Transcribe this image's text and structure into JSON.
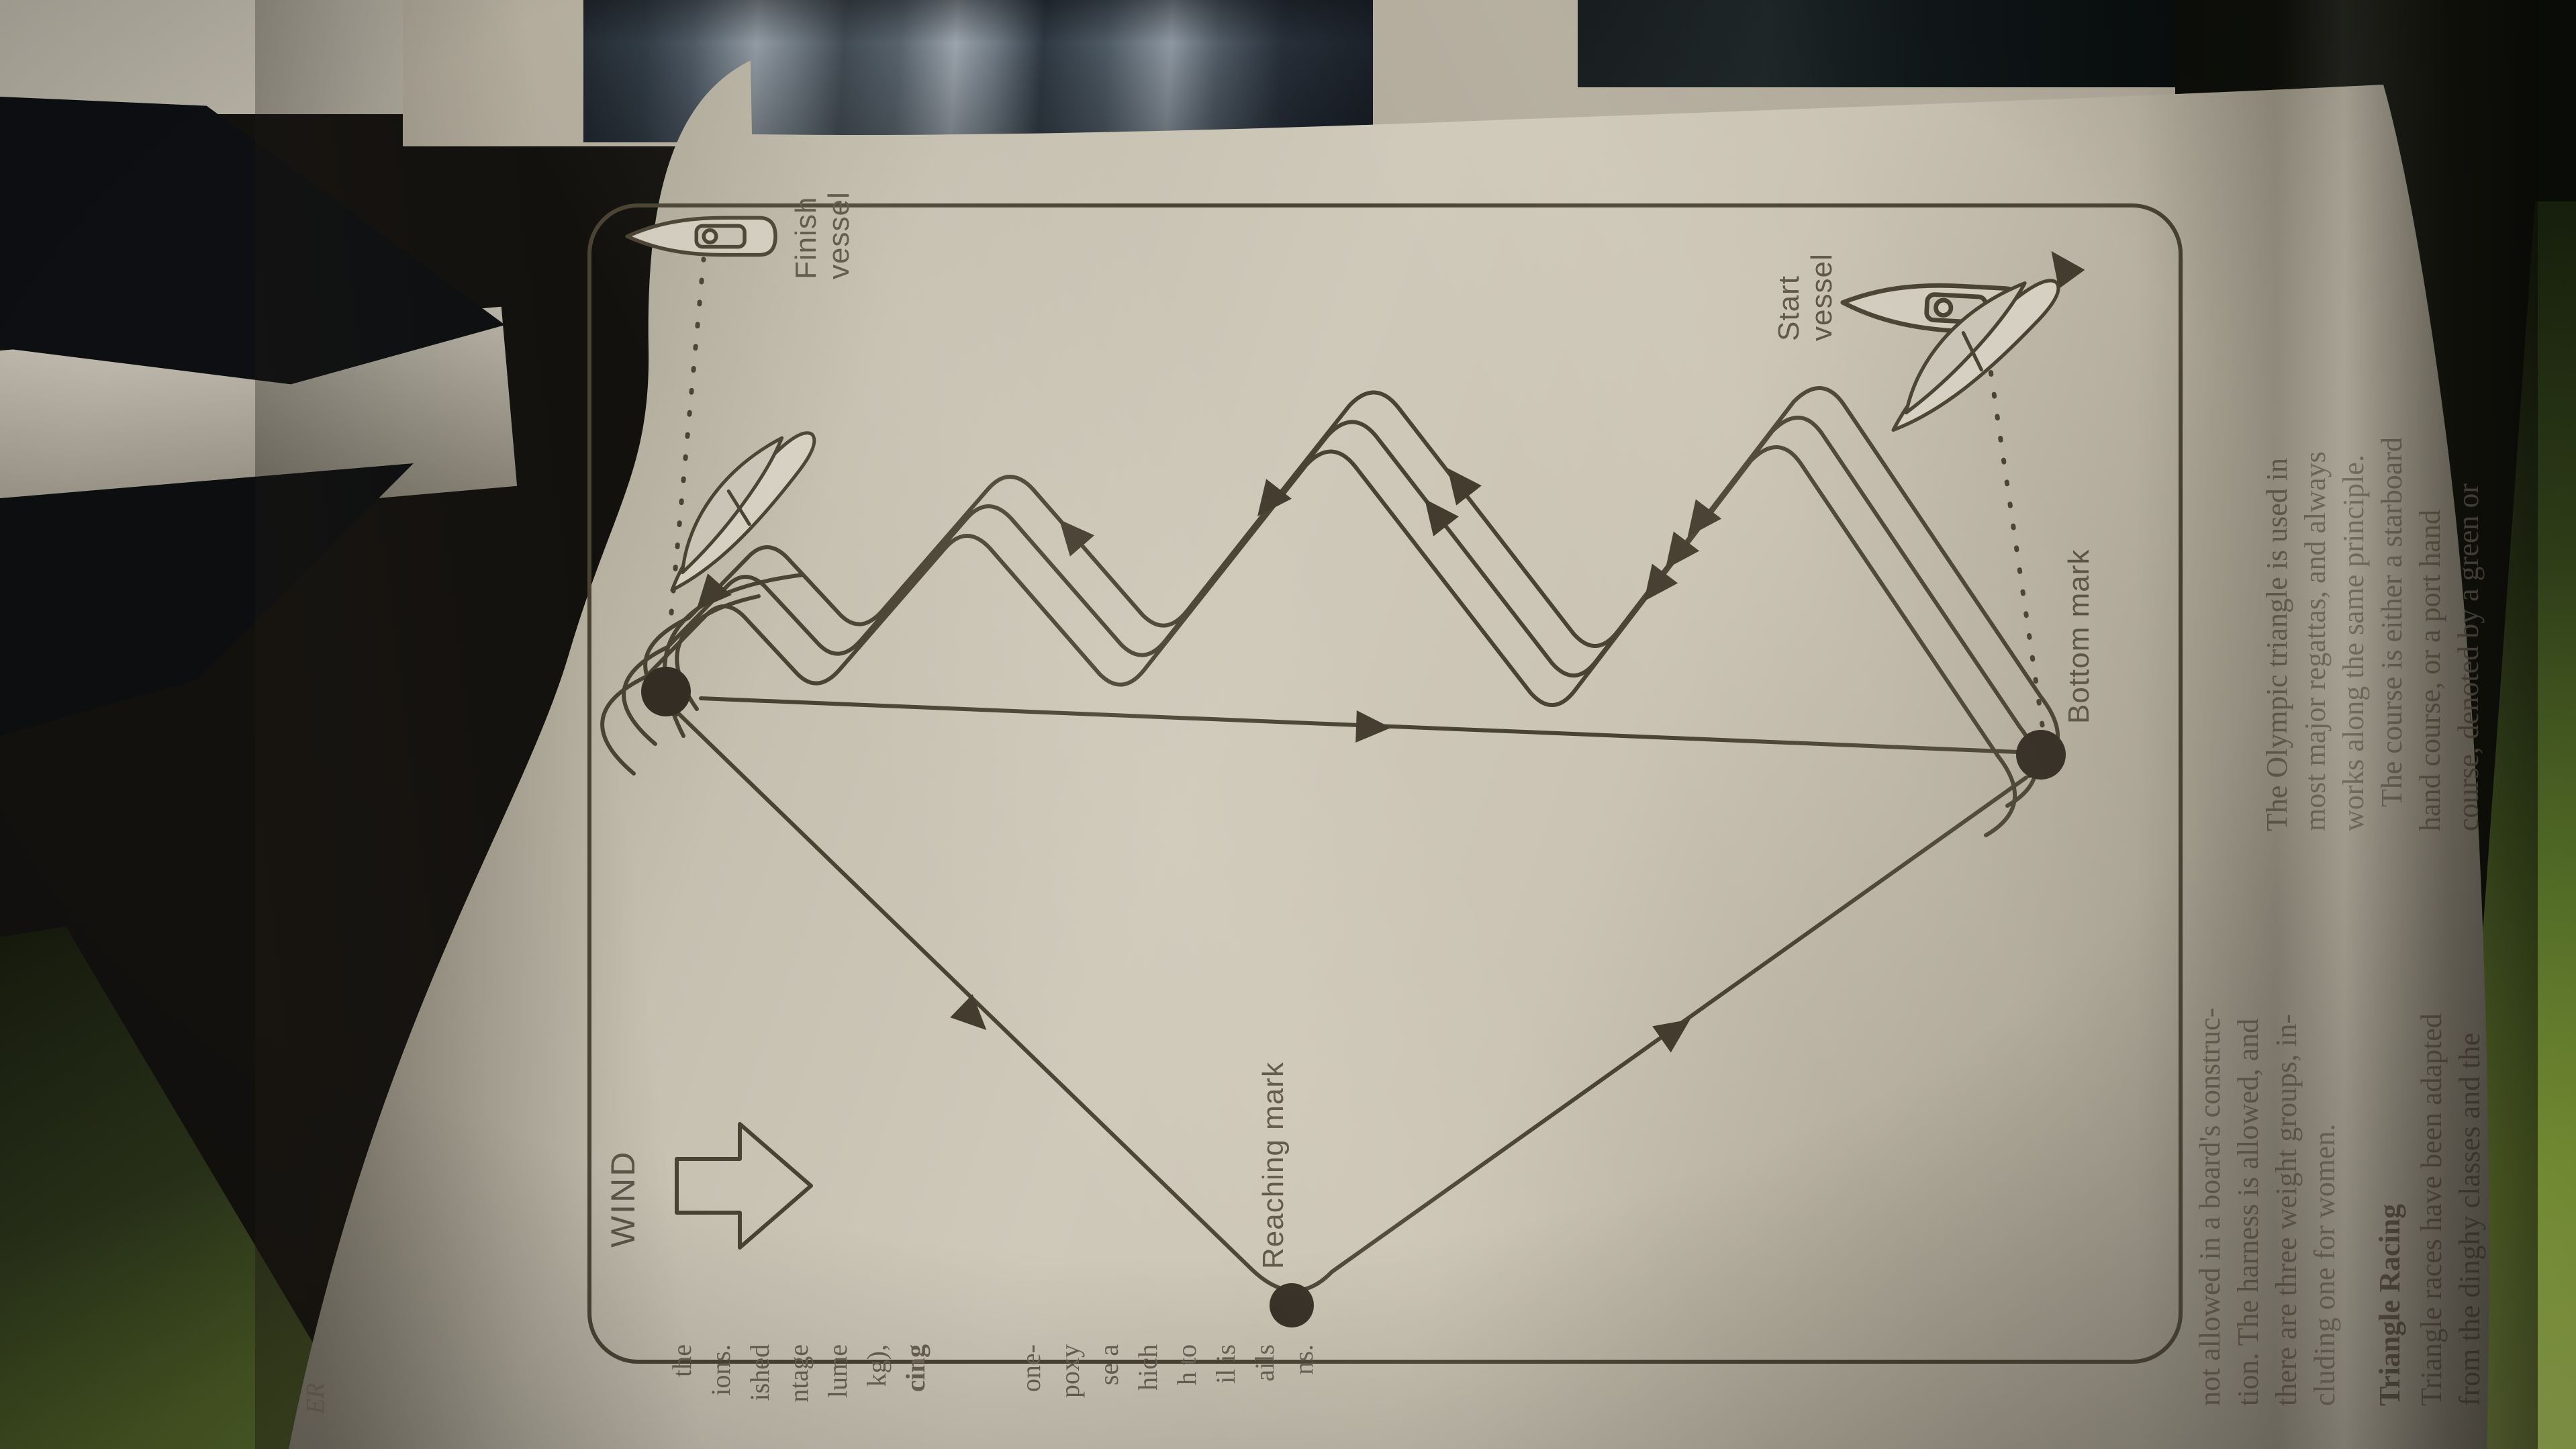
{
  "diagram": {
    "wind_label": "WIND",
    "reaching_mark_label": "Reaching mark",
    "bottom_mark_label": "Bottom mark",
    "finish_vessel_label": "Finish vessel",
    "start_vessel_label": "Start vessel"
  },
  "text_columns": {
    "left": {
      "lines": [
        "not allowed in a board's construc-",
        "tion. The harness is allowed, and",
        "there are three weight groups, in-",
        "cluding one for women."
      ],
      "heading": "Triangle Racing",
      "body_lines": [
        "Triangle races have been adapted",
        "from the dinghy classes and the"
      ]
    },
    "right": {
      "lines": [
        "The Olympic triangle is used in",
        "most major regattas, and always",
        "works along the same principle.",
        "The course is either a starboard",
        "hand course, or a port hand",
        "course, denoted by a green or"
      ]
    }
  },
  "fold_fragments": [
    "the",
    "ions.",
    "ished",
    "ntage",
    "lume",
    "kg),",
    "cing",
    "one-",
    "poxy",
    "se a",
    "hich",
    "h to",
    "il is",
    "ails",
    "ns."
  ],
  "page_edge_fragment": "ER",
  "colors": {
    "paper": "#cdc7b9",
    "ink": "#4a4334",
    "label_text": "#5c5446",
    "green_edge": "#8fae3e",
    "backdrop": "#13110e"
  }
}
